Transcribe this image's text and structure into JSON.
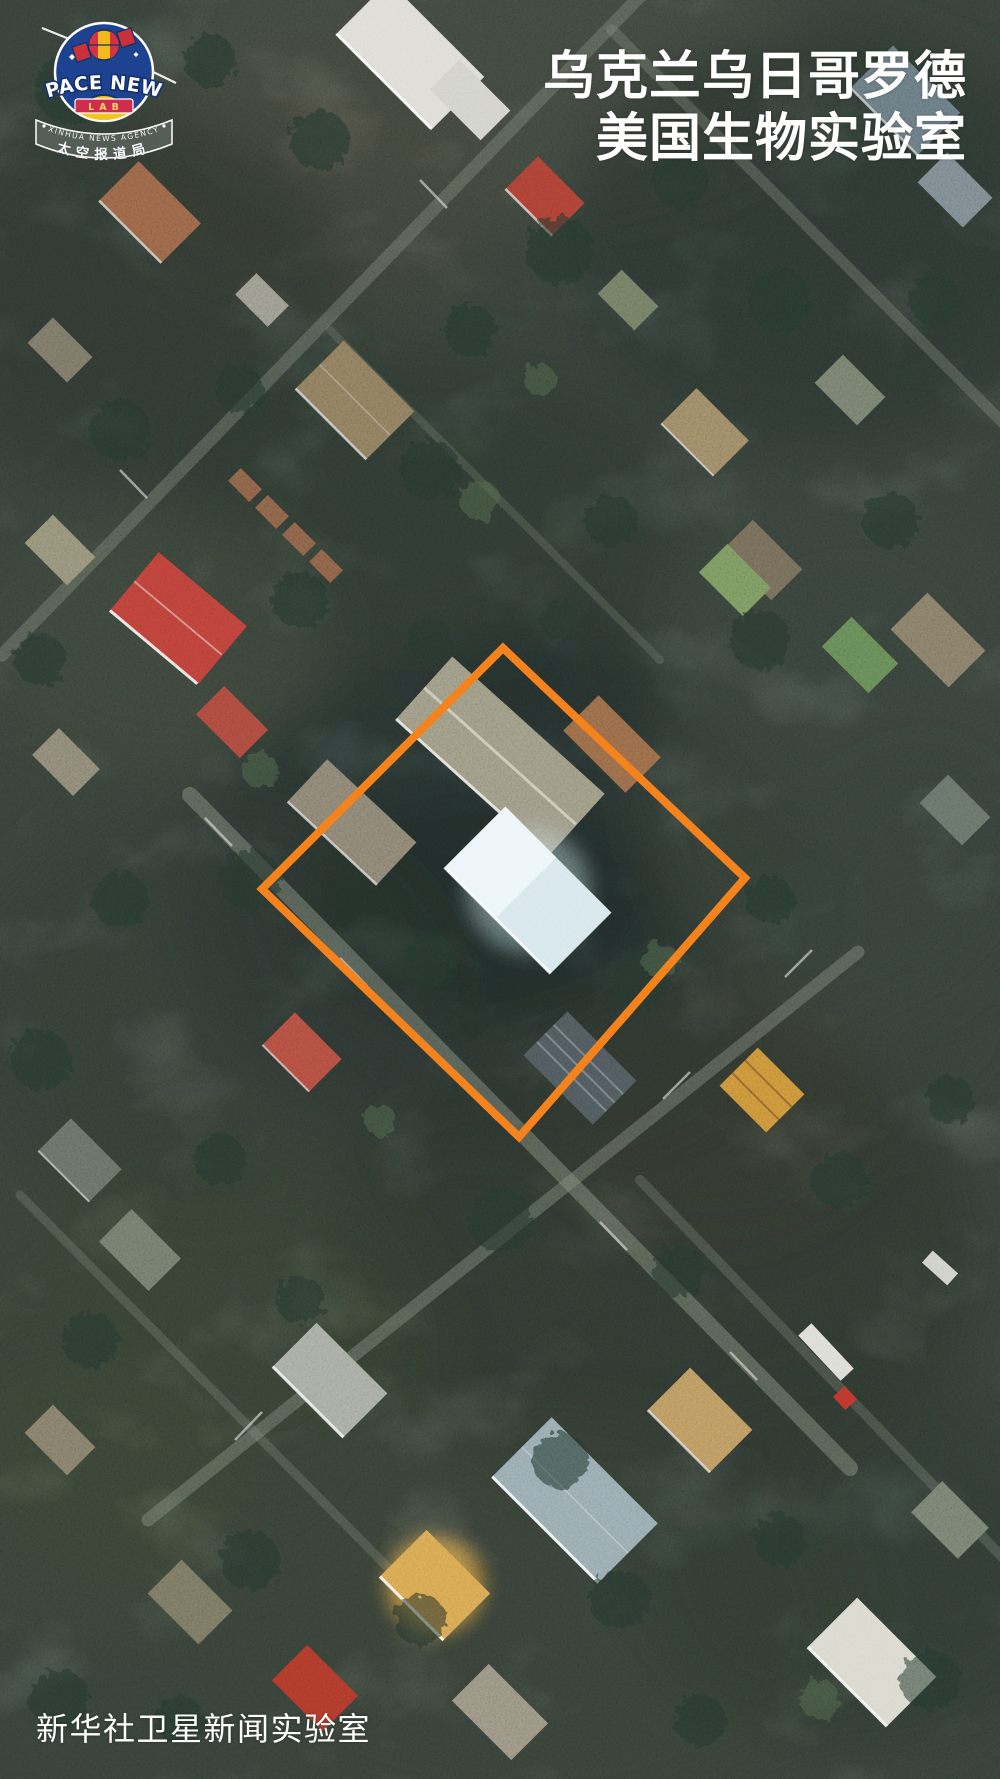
{
  "logo": {
    "name": "SPACE NEWS",
    "sub": "LAB",
    "ribbon_en": "XINHUA NEWS AGENCY",
    "ribbon_cn": "太空报道局",
    "badge_color": "#1d4390",
    "banner_color": "#cf2c4e",
    "sun_color": "#f6c51d"
  },
  "title": {
    "line1": "乌克兰乌日哥罗德",
    "line2": "美国生物实验室",
    "color": "#ffffff"
  },
  "watermark": {
    "text": "新华社卫星新闻实验室",
    "color": "#ffffff"
  },
  "highlight": {
    "shape": "diamond-outline",
    "color": "#F5831D",
    "stroke_width": 8,
    "points": "503,648 745,878 519,1137 262,889"
  }
}
